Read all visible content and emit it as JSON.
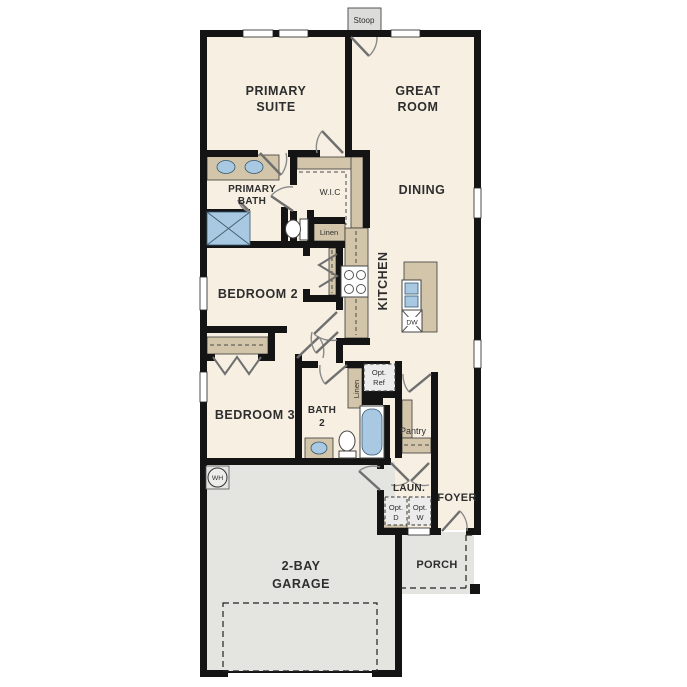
{
  "plan_title": "single-story house floor plan",
  "colors": {
    "floor_interior": "#f6efe2",
    "floor_exterior": "#e4e4e1",
    "wall": "#141414",
    "cabinet_tan": "#d2c5a9",
    "fixture_blue": "#a9c9e3",
    "label_text": "#2e2e2e"
  },
  "labels": {
    "stoop": "Stoop",
    "primary_suite_line1": "PRIMARY",
    "primary_suite_line2": "SUITE",
    "great_room_line1": "GREAT",
    "great_room_line2": "ROOM",
    "primary_bath_line1": "PRIMARY",
    "primary_bath_line2": "BATH",
    "wic": "W.I.C",
    "dining": "DINING",
    "kitchen": "KITCHEN",
    "linen_hall": "Linen",
    "bedroom2": "BEDROOM 2",
    "bedroom3": "BEDROOM 3",
    "bath2_line1": "BATH",
    "bath2_line2": "2",
    "linen_bath2": "Linen",
    "opt_ref_line1": "Opt.",
    "opt_ref_line2": "Ref",
    "pantry": "Pantry",
    "laundry": "LAUN.",
    "foyer": "FOYER",
    "opt_dryer_line1": "Opt.",
    "opt_dryer_line2": "D",
    "opt_washer_line1": "Opt.",
    "opt_washer_line2": "W",
    "garage_line1": "2-BAY",
    "garage_line2": "GARAGE",
    "porch": "PORCH",
    "water_heater": "WH",
    "dishwasher": "DW"
  }
}
